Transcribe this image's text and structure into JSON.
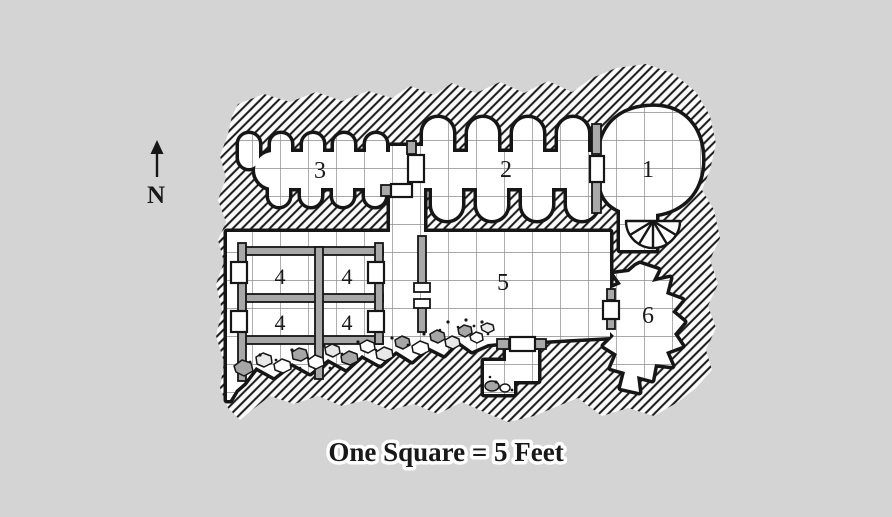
{
  "page": {
    "background_color": "#d4d4d4",
    "caption": "One Square = 5 Feet"
  },
  "compass": {
    "label": "N"
  },
  "map": {
    "colors": {
      "ink": "#161616",
      "paper": "#ffffff",
      "grid": "#8c8c8c",
      "stone_gray": "#a8a8a8"
    },
    "rooms": [
      {
        "id": "room-1",
        "label": "1"
      },
      {
        "id": "room-2",
        "label": "2"
      },
      {
        "id": "room-3",
        "label": "3"
      },
      {
        "id": "cell-4-nw",
        "label": "4"
      },
      {
        "id": "cell-4-ne",
        "label": "4"
      },
      {
        "id": "cell-4-sw",
        "label": "4"
      },
      {
        "id": "cell-4-se",
        "label": "4"
      },
      {
        "id": "room-5",
        "label": "5"
      },
      {
        "id": "room-6",
        "label": "6"
      }
    ]
  }
}
